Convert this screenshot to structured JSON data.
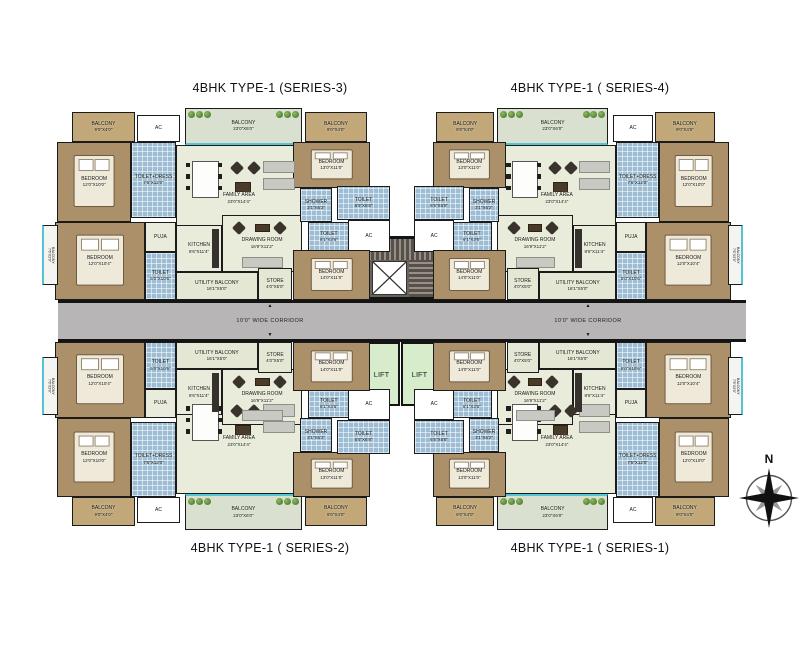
{
  "titles": {
    "series3": "4BHK TYPE-1 (SERIES-3)",
    "series4": "4BHK TYPE-1 ( SERIES-4)",
    "series2": "4BHK TYPE-1 ( SERIES-2)",
    "series1": "4BHK TYPE-1 ( SERIES-1)"
  },
  "corridor": {
    "label": "10'0\" WIDE CORRIDOR",
    "arrow_up": "▲",
    "arrow_down": "▼"
  },
  "lifts": {
    "left": "LIFT",
    "right": "LIFT"
  },
  "compass": {
    "north_label": "N"
  },
  "colors": {
    "walls": "#1b1b1b",
    "bedroom": "#ab906a",
    "toilet_tile": "#9cbdd4",
    "living": "#e9ecda",
    "balcony_tan": "#c2a878",
    "balcony_sage": "#d9e0cf",
    "utility": "#e3e7d3",
    "corridor": "#b8b5b7",
    "lift": "#d6eccb",
    "window_accent": "#53c3d6"
  },
  "units": [
    {
      "name": "unit-series-3",
      "title_key": "series3",
      "x": 40,
      "y": 100,
      "w": 330,
      "h": 200,
      "flip_x": false,
      "flip_y": false
    },
    {
      "name": "unit-series-4",
      "title_key": "series4",
      "x": 433,
      "y": 100,
      "w": 312,
      "h": 200,
      "flip_x": true,
      "flip_y": false
    },
    {
      "name": "unit-series-2",
      "title_key": "series2",
      "x": 40,
      "y": 342,
      "w": 330,
      "h": 196,
      "flip_x": false,
      "flip_y": true
    },
    {
      "name": "unit-series-1",
      "title_key": "series1",
      "x": 433,
      "y": 342,
      "w": 312,
      "h": 196,
      "flip_x": true,
      "flip_y": true
    }
  ],
  "rooms": [
    {
      "name": "balcony-corner-outer",
      "type": "balcony-tan",
      "label": "BALCONY",
      "dims": "9'0\"X4'0\"",
      "x": 9.7,
      "y": 6,
      "w": 19.1,
      "h": 15
    },
    {
      "name": "ac-top",
      "type": "ac",
      "label": "AC",
      "dims": "",
      "x": 29.4,
      "y": 7.5,
      "w": 13,
      "h": 13.5
    },
    {
      "name": "balcony-main",
      "type": "balcony-sage",
      "label": "BALCONY",
      "dims": "23'0\"X6'0\"",
      "x": 43.9,
      "y": 4,
      "w": 35.5,
      "h": 18.5,
      "furniture": "plants"
    },
    {
      "name": "balcony-corner-inner",
      "type": "balcony-tan",
      "label": "BALCONY",
      "dims": "9'0\"X4'0\"",
      "x": 80.3,
      "y": 6,
      "w": 18.8,
      "h": 15
    },
    {
      "name": "family-area",
      "type": "living",
      "label": "FAMILY AREA",
      "dims": "23'0\"X14'4\"",
      "x": 41.2,
      "y": 22.5,
      "w": 38.2,
      "h": 53.5,
      "furniture": "living-set"
    },
    {
      "name": "drawing-room",
      "type": "living",
      "label": "DRAWING ROOM",
      "dims": "16'9\"X11'2\"",
      "x": 55.2,
      "y": 57.5,
      "w": 24.2,
      "h": 28.5,
      "furniture": "sofa-set"
    },
    {
      "name": "kitchen",
      "type": "living",
      "label": "KITCHEN",
      "dims": "8'6\"X11'4\"",
      "x": 41.2,
      "y": 62.5,
      "w": 14,
      "h": 23.5,
      "furniture": "counter"
    },
    {
      "name": "puja",
      "type": "living",
      "label": "PUJA",
      "dims": "",
      "x": 31.8,
      "y": 61,
      "w": 9.4,
      "h": 15
    },
    {
      "name": "bedroom-a",
      "type": "bedroom",
      "label": "BEDROOM",
      "dims": "12'0\"X10'0\"",
      "x": 5.2,
      "y": 21,
      "w": 22.4,
      "h": 40,
      "furniture": "bed"
    },
    {
      "name": "toilet-dress",
      "type": "toilet",
      "label": "TOILET+DRESS",
      "dims": "7'6\"X12'0\"",
      "x": 27.6,
      "y": 21,
      "w": 13.6,
      "h": 38
    },
    {
      "name": "bedroom-b",
      "type": "bedroom",
      "label": "BEDROOM",
      "dims": "13'0\"X11'0\"",
      "x": 76.7,
      "y": 21,
      "w": 23.3,
      "h": 23,
      "furniture": "bed"
    },
    {
      "name": "shower",
      "type": "toilet",
      "label": "SHOWER",
      "dims": "3'1\"X6'2\"",
      "x": 78.8,
      "y": 44,
      "w": 9.7,
      "h": 17
    },
    {
      "name": "toilet-top",
      "type": "toilet",
      "label": "TOILET",
      "dims": "6'5\"X6'8\"",
      "x": 90,
      "y": 43,
      "w": 16.1,
      "h": 17
    },
    {
      "name": "toilet-bot",
      "type": "toilet",
      "label": "TOILET",
      "dims": "6'1\"X3'6\"",
      "x": 81.2,
      "y": 61,
      "w": 12.7,
      "h": 15
    },
    {
      "name": "ac-core",
      "type": "ac",
      "label": "AC",
      "dims": "",
      "x": 93.3,
      "y": 60,
      "w": 12.7,
      "h": 16
    },
    {
      "name": "bedroom-c",
      "type": "bedroom",
      "label": "BEDROOM",
      "dims": "12'0\"X10'4\"",
      "x": 4.5,
      "y": 61,
      "w": 27.3,
      "h": 39,
      "furniture": "bed"
    },
    {
      "name": "balcony-side",
      "type": "balcony-side",
      "label": "BALCONY",
      "dims": "7'6\"X3'0\"",
      "x": 0.6,
      "y": 62.5,
      "w": 4.8,
      "h": 30,
      "vertical": true
    },
    {
      "name": "toilet-d",
      "type": "toilet",
      "label": "TOILET",
      "dims": "5'0\"X10'6\"",
      "x": 31.8,
      "y": 76,
      "w": 9.4,
      "h": 24
    },
    {
      "name": "utility-balcony",
      "type": "utility",
      "label": "UTILITY BALCONY",
      "dims": "16'1\"X5'0\"",
      "x": 41.2,
      "y": 86,
      "w": 24.8,
      "h": 14
    },
    {
      "name": "store",
      "type": "utility",
      "label": "STORE",
      "dims": "4'0\"X5'0\"",
      "x": 66.1,
      "y": 84,
      "w": 10.3,
      "h": 16
    },
    {
      "name": "bedroom-d",
      "type": "bedroom",
      "label": "BEDROOM",
      "dims": "14'0\"X11'0\"",
      "x": 76.7,
      "y": 75,
      "w": 23.3,
      "h": 25,
      "furniture": "bed"
    }
  ]
}
